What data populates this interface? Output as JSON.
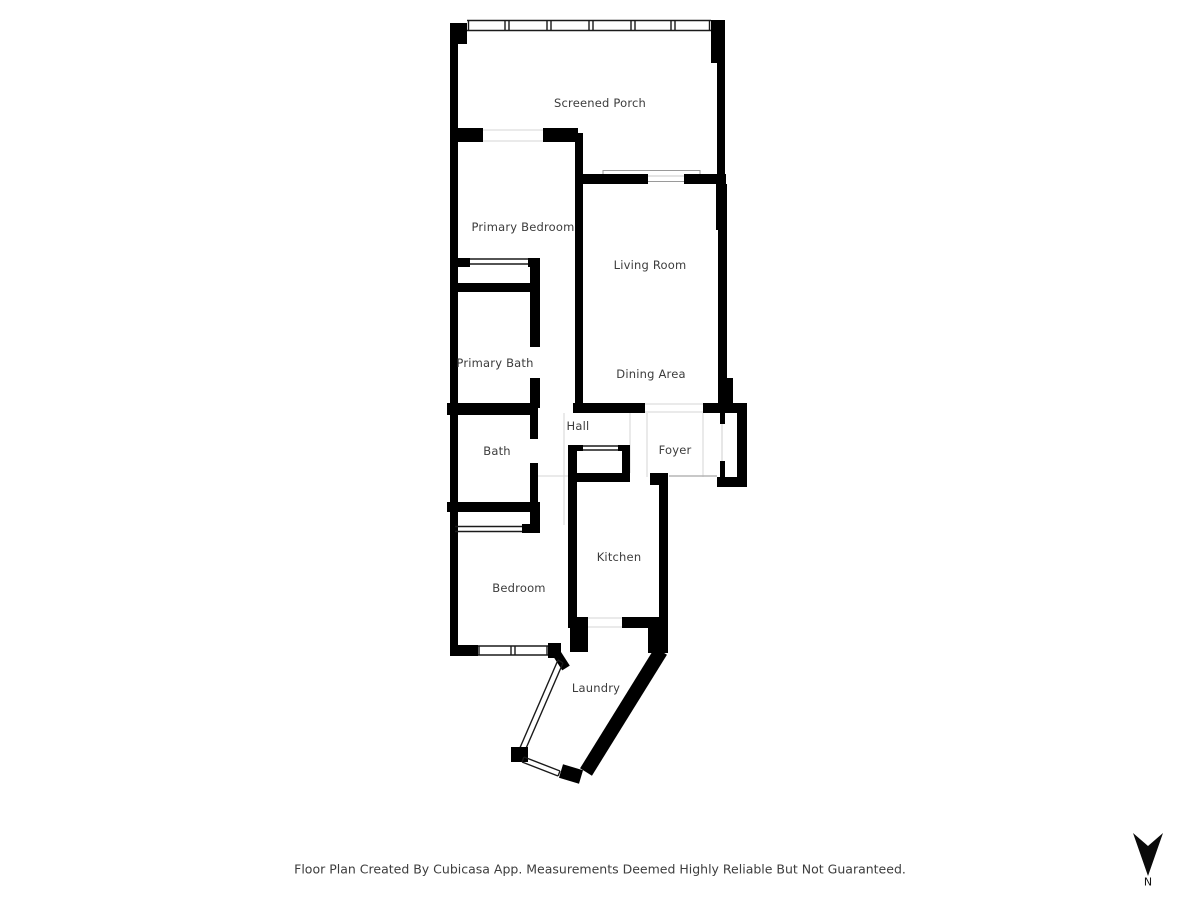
{
  "rooms": [
    {
      "label": "Screened Porch"
    },
    {
      "label": "Primary Bedroom"
    },
    {
      "label": "Living Room"
    },
    {
      "label": "Primary Bath"
    },
    {
      "label": "Dining Area"
    },
    {
      "label": "Hall"
    },
    {
      "label": "Bath"
    },
    {
      "label": "Foyer"
    },
    {
      "label": "Kitchen"
    },
    {
      "label": "Bedroom"
    },
    {
      "label": "Laundry"
    }
  ],
  "compass": {
    "label": "N",
    "direction": "arrow-pointing-down"
  },
  "footer": {
    "disclaimer": "Floor Plan Created By Cubicasa App. Measurements Deemed Highly Reliable But Not Guaranteed."
  },
  "colors": {
    "wall": "#000000",
    "background": "#ffffff",
    "label_text": "#3c3c3c",
    "thin_line": "#c9c9c9"
  }
}
